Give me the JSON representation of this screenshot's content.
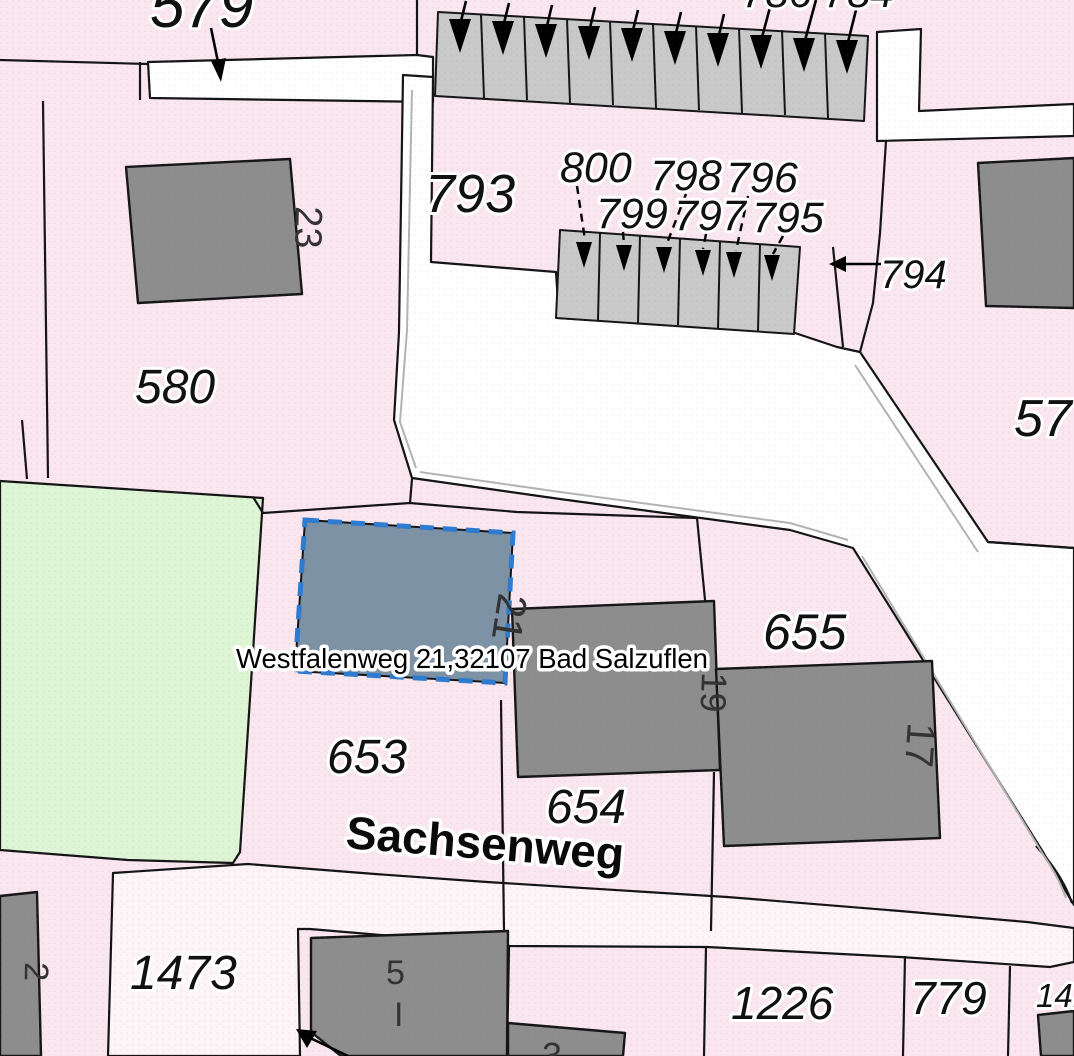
{
  "map_type": "cadastral-parcel-map",
  "selection": {
    "address_label": "Westfalenweg 21,32107 Bad Salzuflen",
    "parcel_building_number": "21"
  },
  "street": {
    "name": "Sachsenweg"
  },
  "labels": {
    "p579": "579",
    "p580": "580",
    "p793": "793",
    "p794": "794",
    "p795": "795",
    "p796": "796",
    "p797": "797",
    "p798": "798",
    "p799": "799",
    "p800": "800",
    "p653": "653",
    "p654": "654",
    "p655": "655",
    "p57_cut": "57",
    "p1473": "1473",
    "p1226": "1226",
    "p779": "779",
    "p141_cut": "141",
    "top_fragment_cut": "786 784"
  },
  "buildings": {
    "b23": "23",
    "b21": "21",
    "b19": "19",
    "b17": "17",
    "b2": "2",
    "b5": "5",
    "b5_storeys": "I",
    "b3": "3"
  },
  "colors": {
    "parcel_pink": "#fae6ef",
    "parcel_light": "#fdf4f8",
    "green_space": "#def5d5",
    "road_white": "#ffffff",
    "building_gray": "#8d8d8d",
    "rowhouse_gray": "#c9c9c9",
    "boundary_black": "#141414",
    "highlight_fill": "#7d93a5",
    "highlight_border": "#2e7bd0"
  }
}
